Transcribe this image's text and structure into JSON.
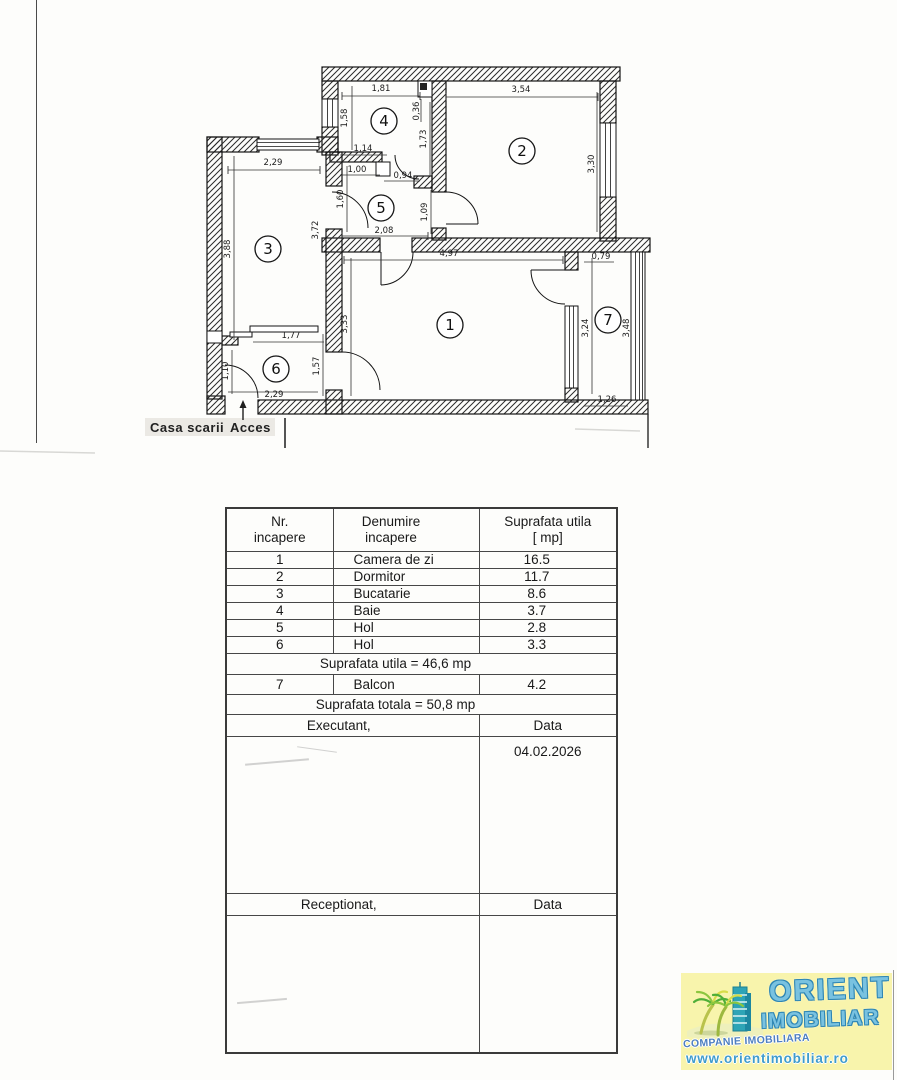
{
  "plan": {
    "room_numbers": {
      "r1": "1",
      "r2": "2",
      "r3": "3",
      "r4": "4",
      "r5": "5",
      "r6": "6",
      "r7": "7"
    },
    "dims": {
      "d181": "1,81",
      "d354": "3,54",
      "d158": "1,58",
      "d036": "0,36",
      "d173": "1,73",
      "d330": "3,30",
      "d229t": "2,29",
      "d114": "1,14",
      "d100": "1,00",
      "d094": "0,94",
      "d160": "1,60",
      "d109": "1,09",
      "d208": "2,08",
      "d388": "3,88",
      "d372": "3,72",
      "d497": "4,97",
      "d333": "3,33",
      "d079": "0,79",
      "d324": "3,24",
      "d348": "3,48",
      "d177": "1,77",
      "d110": "1,10",
      "d157": "1,57",
      "d229b": "2,29",
      "d126": "1,26"
    },
    "annotations": {
      "casa_scarii": "Casa scarii",
      "acces": "Acces"
    }
  },
  "table": {
    "header": {
      "col1a": "Nr.",
      "col1b": "incapere",
      "col2a": "Denumire",
      "col2b": "incapere",
      "col3a": "Suprafata utila",
      "col3b": "[ mp]"
    },
    "rows": [
      {
        "nr": "1",
        "name": "Camera de zi",
        "area": "16.5"
      },
      {
        "nr": "2",
        "name": "Dormitor",
        "area": "11.7"
      },
      {
        "nr": "3",
        "name": "Bucatarie",
        "area": "8.6"
      },
      {
        "nr": "4",
        "name": "Baie",
        "area": "3.7"
      },
      {
        "nr": "5",
        "name": "Hol",
        "area": "2.8"
      },
      {
        "nr": "6",
        "name": "Hol",
        "area": "3.3"
      }
    ],
    "subtotal": "Suprafata utila = 46,6 mp",
    "balcony_row": {
      "nr": "7",
      "name": "Balcon",
      "area": "4.2"
    },
    "total": "Suprafata totala = 50,8 mp",
    "executant_label": "Executant,",
    "executant_data_label": "Data",
    "date_value": "04.02.2026",
    "receptionat_label": "Receptionat,",
    "receptionat_data_label": "Data"
  },
  "logo": {
    "brand_top": "ORIENT",
    "brand_bottom": "IMOBILIAR",
    "company_line": "COMPANIE IMOBILIARA",
    "website": "www.orientimobiliar.ro",
    "colors": {
      "background": "#f8f4ac",
      "brand_blue": "#56b0d6",
      "company_blue": "#4e7fc0",
      "web_blue": "#3f9ccc"
    }
  }
}
